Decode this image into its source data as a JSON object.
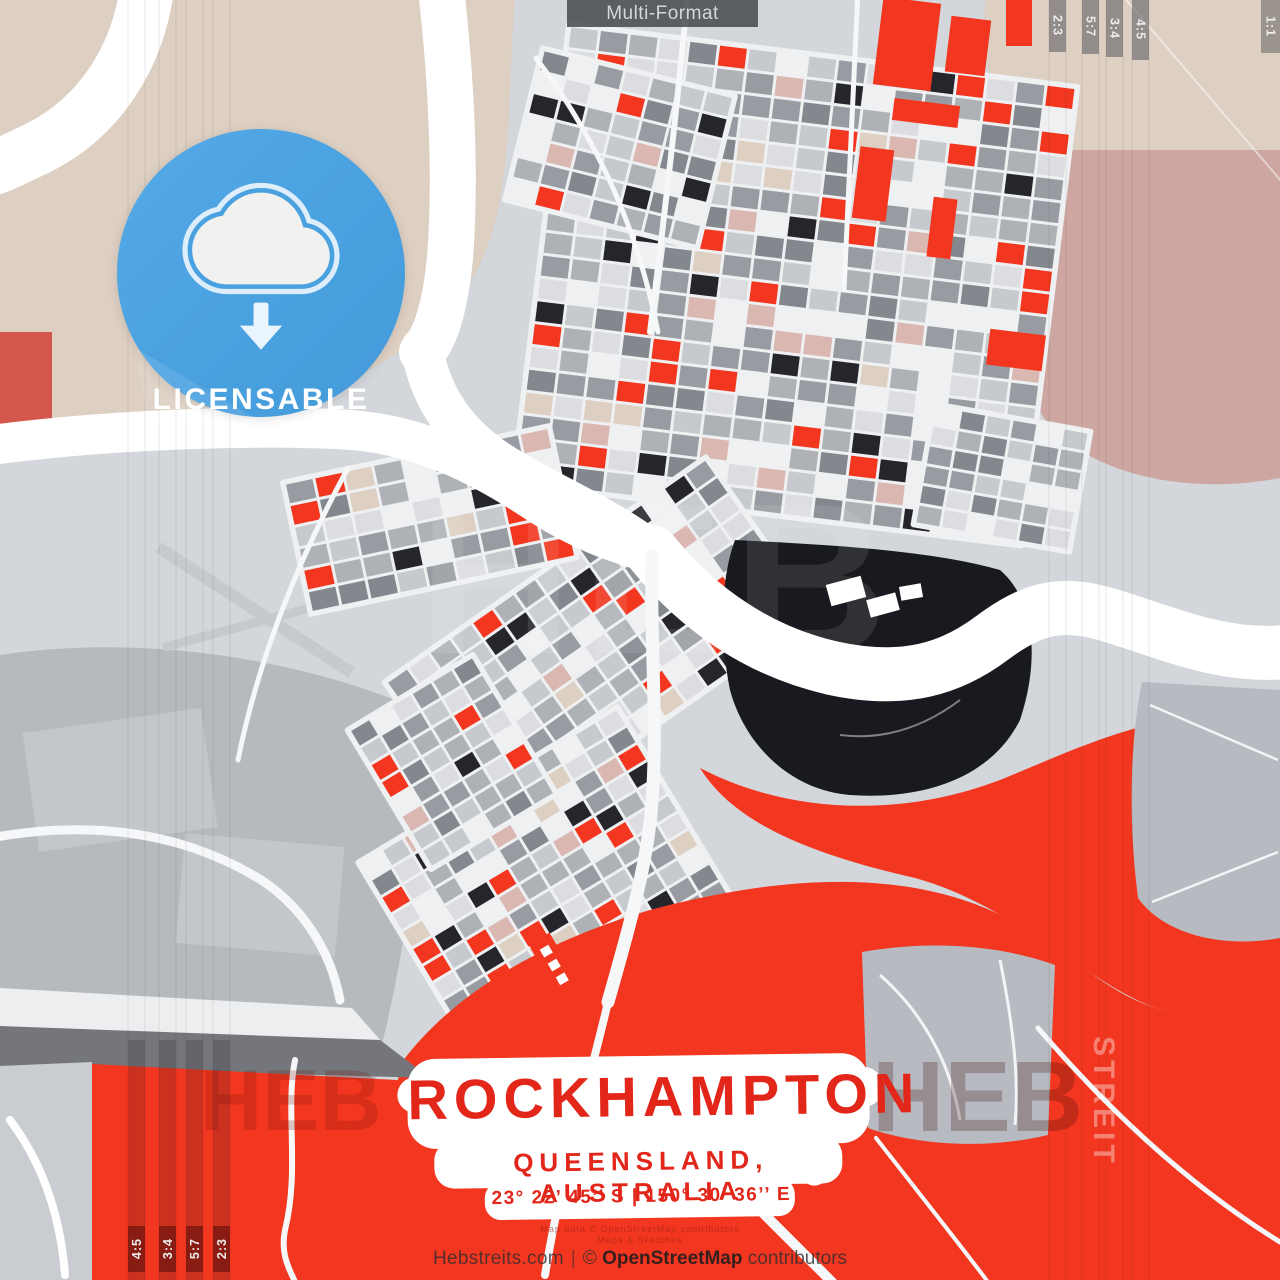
{
  "header": {
    "format_label": "Multi-Format"
  },
  "badge": {
    "label": "LICENSABLE",
    "icon": "cloud-download-icon",
    "color": "#4aa1e0"
  },
  "title_block": {
    "city": "ROCKHAMPTON",
    "region": "QUEENSLAND, AUSTRALIA",
    "coordinates": "23° 22’ 45’’ S | 150° 30’ 36’’ E",
    "accent_color": "#e2261a"
  },
  "footer": {
    "site": "Hebstreits.com",
    "divider": "|",
    "copyright": "©",
    "osm": "OpenStreetMap",
    "contributors": "contributors",
    "fine_print": [
      "Map data © OpenStreetMap contributors",
      "Maps & Sketches"
    ]
  },
  "aspect_markers": {
    "top_right": [
      "2:3",
      "5:7",
      "3:4",
      "4:5"
    ],
    "corner_top_right": "1:1",
    "bottom_left": [
      "4:5",
      "3:4",
      "5:7",
      "2:3"
    ]
  },
  "watermarks": {
    "heb_center": "HEB",
    "heb_bottom_left": "HEB",
    "heb_bottom_right": "HEB",
    "streit_vertical": "STREIT"
  },
  "map": {
    "subject": "Rockhampton street map art",
    "colors": {
      "background": "#d3d6da",
      "beige": "#ddcfc2",
      "mauve": "#cda6a1",
      "pink": "#dbb7b2",
      "salmon": "#d4574e",
      "red": "#f2361f",
      "water_dark": "#181a1f",
      "river": "#ffffff",
      "street": "#eef0f1",
      "block_dark": "#24262b",
      "gray_1": "#83878e",
      "gray_2": "#989ca2",
      "gray_3": "#aeb1b6",
      "gray_4": "#c6c9cd",
      "gray_5": "#dbdde0",
      "white_block": "#f0f1f2",
      "gray_region": "#b6b9be",
      "dark_band": "#74767b"
    }
  }
}
